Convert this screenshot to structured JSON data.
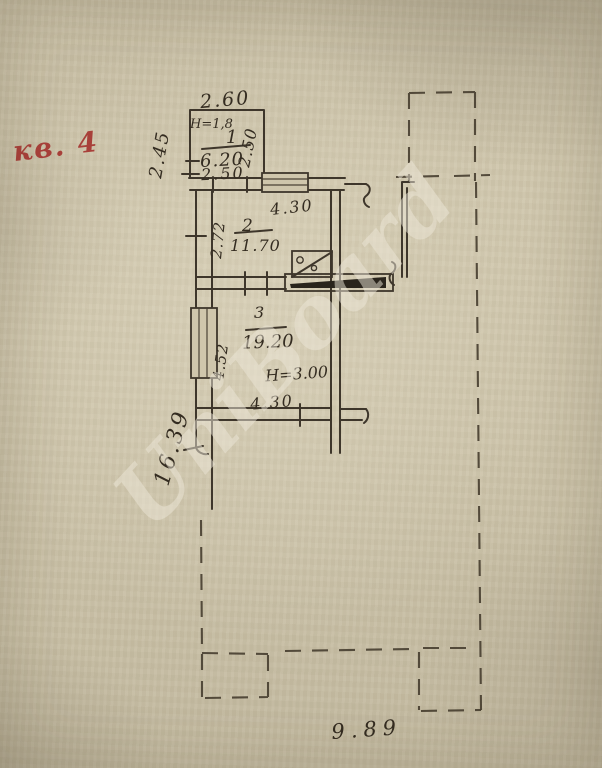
{
  "annotations": {
    "apartment_label": "кв. 4",
    "watermark": "UniBoard"
  },
  "rooms": [
    {
      "number": "1",
      "area": "6.20",
      "height_note": "H=1,8",
      "dims": {
        "top": "2.60",
        "left": "2.45",
        "right": "2.50",
        "bottom": "2.50"
      }
    },
    {
      "number": "2",
      "area": "11.70",
      "dims": {
        "top": "4.30",
        "left": "2.72"
      }
    },
    {
      "number": "3",
      "area": "19.20",
      "height_note": "H=3.00",
      "dims": {
        "left": "4.52",
        "bottom": "4.30"
      }
    }
  ],
  "outer_dimensions": {
    "left_total": "16.39",
    "bottom_total": "9.89"
  },
  "symbols": [
    "stove-symbol",
    "window-symbol",
    "doorway-jambs",
    "wall-break-mark",
    "dashed-building-outline"
  ],
  "colors": {
    "paper": "#cbc2a8",
    "ink": "#3e362b",
    "red_ink": "#a8403a",
    "watermark": "#ede7d8"
  }
}
